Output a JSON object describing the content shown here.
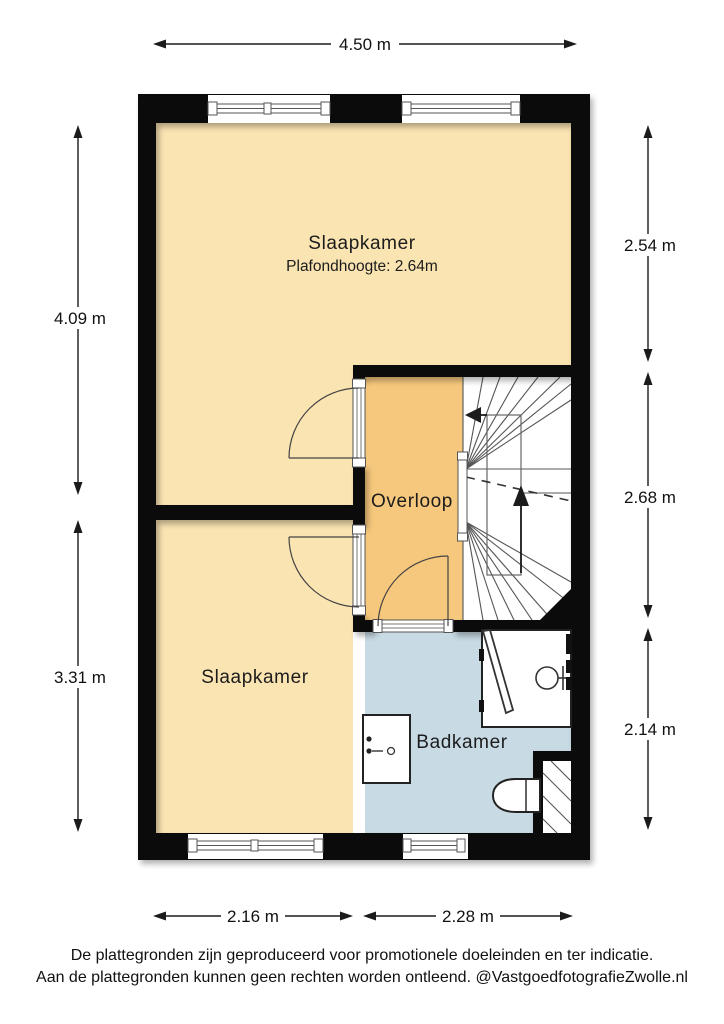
{
  "rooms": [
    {
      "name": "Slaapkamer",
      "ceiling_note": "Plafondhoogte: 2.64m"
    },
    {
      "name": "Overloop"
    },
    {
      "name": "Slaapkamer"
    },
    {
      "name": "Badkamer"
    }
  ],
  "dimensions": {
    "top_width": "4.50 m",
    "left_upper": "4.09 m",
    "left_lower": "3.31 m",
    "right_upper": "2.54 m",
    "right_middle": "2.68 m",
    "right_lower": "2.14 m",
    "bottom_left": "2.16 m",
    "bottom_right": "2.28 m"
  },
  "footer": {
    "line1": "De plattegronden zijn geproduceerd voor promotionele doeleinden en ter indicatie.",
    "line2": "Aan de plattegronden kunnen geen rechten worden ontleend. @VastgoedfotografieZwolle.nl"
  },
  "colors": {
    "floor_cream": "#FAE4B2",
    "floor_orange": "#F6C87D",
    "floor_blue": "#C8DAE4",
    "stairs_white": "#FFFFFF",
    "wall": "#0b0b0b",
    "background": "#FFFFFF"
  }
}
